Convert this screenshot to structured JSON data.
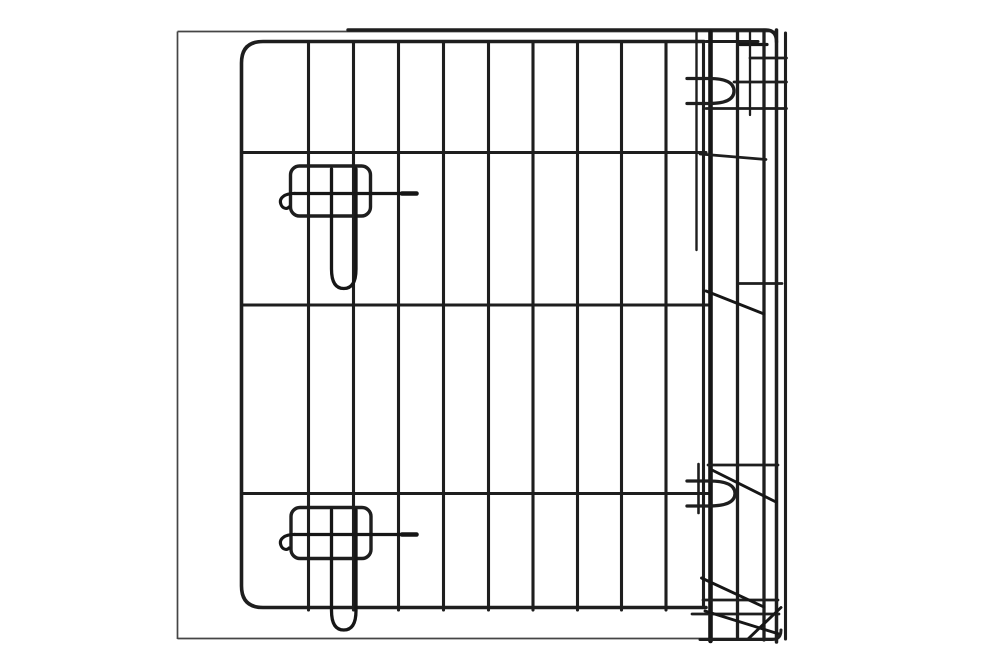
{
  "meta": {
    "alt": "Close-up product photo of a black wire pet crate door with two slide-bolt latches, hinge loops and a corner post, on a white background",
    "width_px": 1000,
    "height_px": 657
  },
  "colors": {
    "background": "#ffffff",
    "wire": "#1e1e1e",
    "wire_dark": "#161616",
    "frame_outline": "#454545"
  },
  "scene": {
    "type": "product-photo",
    "subject": "wire crate door close-up",
    "parts": {
      "photo_frame": "thin light-gray rectangular outline around the crate",
      "door": "black wire grid door with rounded left corners, 9 inner vertical wires and 3 inner horizontal wires",
      "latches": [
        "upper slide-bolt latch with U-shaped drop bolt",
        "lower slide-bolt latch with U-shaped drop bolt"
      ],
      "hinge_side": "right-hand corner post with dense vertical wires, two hinge loops and diagonal braces"
    }
  }
}
